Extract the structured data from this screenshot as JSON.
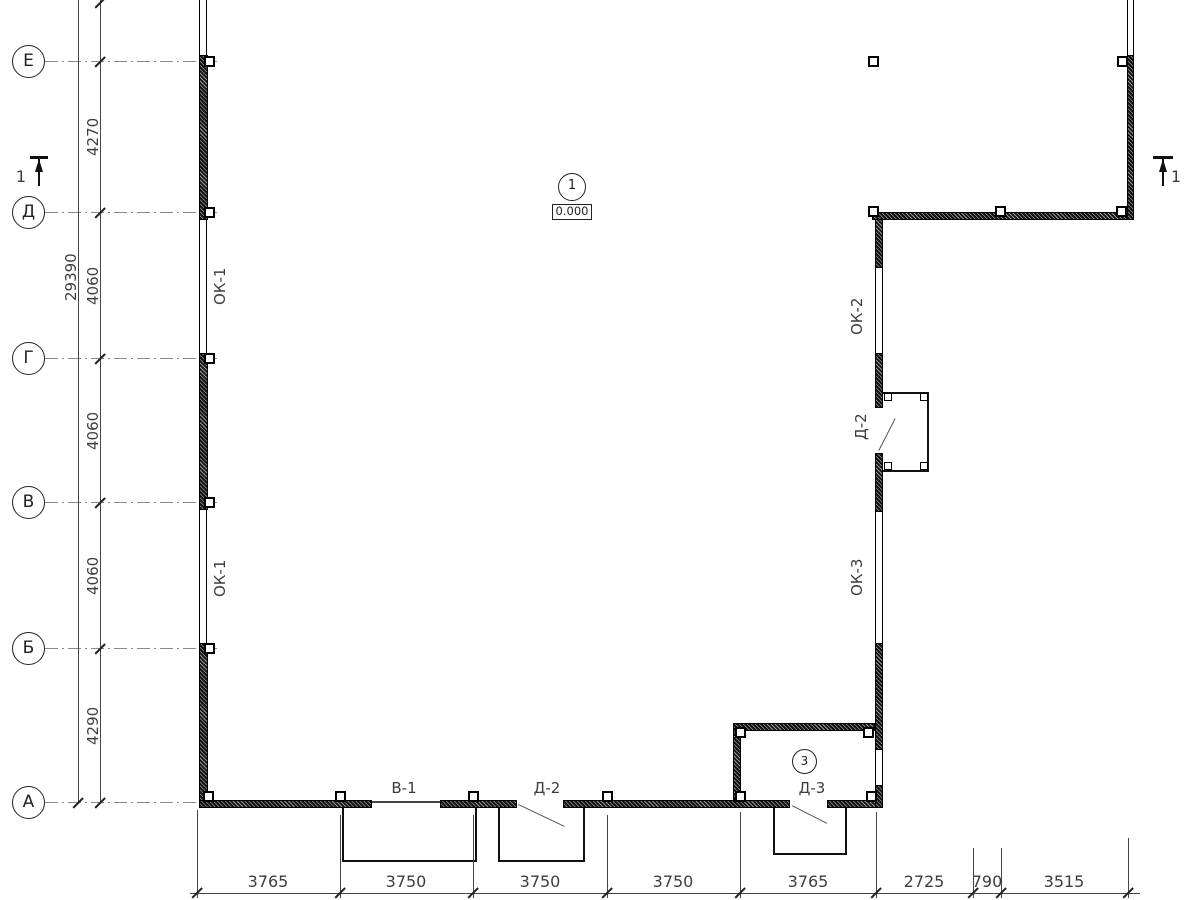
{
  "axes": [
    {
      "label": "Е"
    },
    {
      "label": "Д"
    },
    {
      "label": "Г"
    },
    {
      "label": "В"
    },
    {
      "label": "Б"
    },
    {
      "label": "А"
    }
  ],
  "dims": {
    "overall_left": "29390",
    "left_segments": [
      "4270",
      "4060",
      "4060",
      "4060",
      "4290"
    ],
    "bottom": [
      "3765",
      "3750",
      "3750",
      "3750",
      "3765",
      "2725",
      "790",
      "3515"
    ]
  },
  "marks": {
    "section": "1",
    "node": "1",
    "level": "0.000",
    "room": "3"
  },
  "openings": {
    "ok1_upper": "ОК-1",
    "ok1_lower": "ОК-1",
    "ok2": "ОК-2",
    "ok3": "ОК-3",
    "d2_right": "Д-2",
    "v1": "В-1",
    "d2_bottom": "Д-2",
    "d3": "Д-3"
  }
}
